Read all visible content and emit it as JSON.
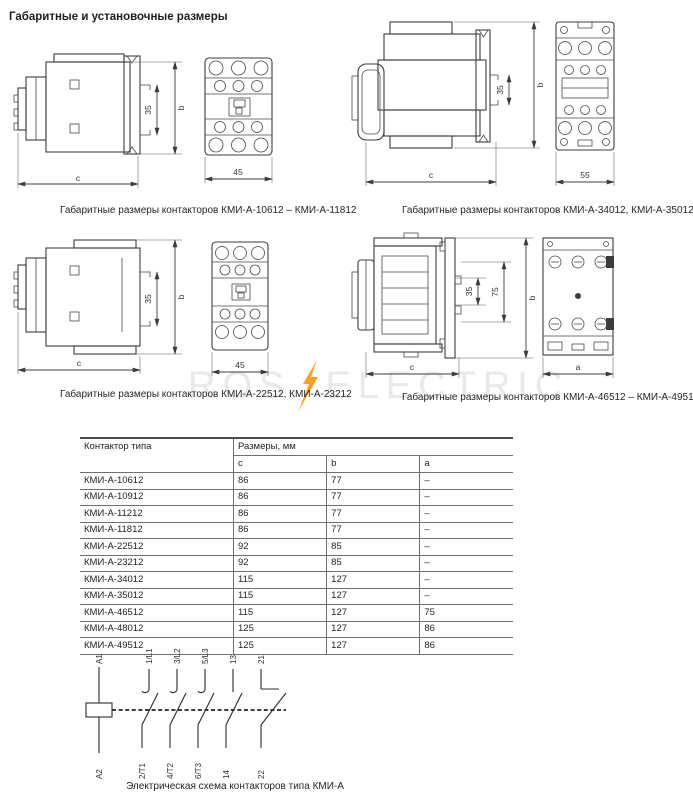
{
  "page_title": "Габаритные и установочные размеры",
  "watermark": {
    "left": "ROS",
    "right": "ELECTRIC",
    "accent_color": "#f7a01e"
  },
  "drawings": [
    {
      "caption": "Габаритные размеры контакторов КМИ-А-10612 – КМИ-А-11812",
      "dims": {
        "inner": "35",
        "total": "b",
        "depth": "c",
        "width": "45"
      }
    },
    {
      "caption": "Габаритные размеры контакторов КМИ-А-34012, КМИ-А-35012",
      "dims": {
        "inner": "35",
        "total": "b",
        "depth": "c",
        "width": "55"
      }
    },
    {
      "caption": "Габаритные размеры контакторов КМИ-А-22512, КМИ-А-23212",
      "dims": {
        "inner": "35",
        "total": "b",
        "depth": "c",
        "width": "45"
      }
    },
    {
      "caption": "Габаритные размеры контакторов КМИ-А-46512 – КМИ-А-49512",
      "dims": {
        "inner": "35",
        "mid": "75",
        "total": "b",
        "depth": "c",
        "width": "a"
      }
    }
  ],
  "table": {
    "col1_header": "Контактор типа",
    "group_header": "Размеры, мм",
    "sub_headers": [
      "c",
      "b",
      "a"
    ],
    "rows": [
      [
        "КМИ-А-10612",
        "86",
        "77",
        "–"
      ],
      [
        "КМИ-А-10912",
        "86",
        "77",
        "–"
      ],
      [
        "КМИ-А-11212",
        "86",
        "77",
        "–"
      ],
      [
        "КМИ-А-11812",
        "86",
        "77",
        "–"
      ],
      [
        "КМИ-А-22512",
        "92",
        "85",
        "–"
      ],
      [
        "КМИ-А-23212",
        "92",
        "85",
        "–"
      ],
      [
        "КМИ-А-34012",
        "115",
        "127",
        "–"
      ],
      [
        "КМИ-А-35012",
        "115",
        "127",
        "–"
      ],
      [
        "КМИ-А-46512",
        "115",
        "127",
        "75"
      ],
      [
        "КМИ-А-48012",
        "125",
        "127",
        "86"
      ],
      [
        "КМИ-А-49512",
        "125",
        "127",
        "86"
      ]
    ]
  },
  "schematic": {
    "caption": "Электрическая схема контакторов типа КМИ-А",
    "coil": {
      "top": "A1",
      "bottom": "A2"
    },
    "poles": [
      {
        "top": "1/L1",
        "bottom": "2/T1"
      },
      {
        "top": "3/L2",
        "bottom": "4/T2"
      },
      {
        "top": "5/L3",
        "bottom": "6/T3"
      },
      {
        "top": "13",
        "bottom": "14"
      },
      {
        "top": "21",
        "bottom": "22"
      }
    ]
  }
}
